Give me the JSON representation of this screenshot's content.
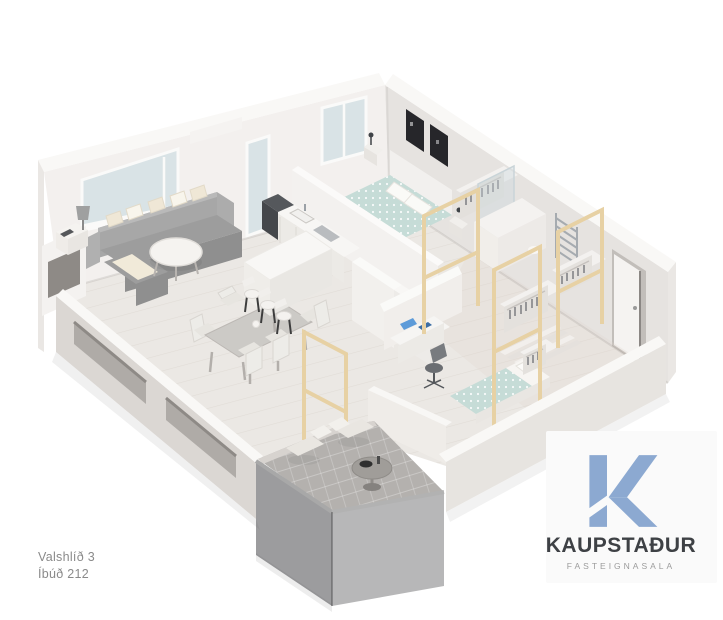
{
  "address": {
    "line1": "Valshlíð 3",
    "line2": "Íbúð 212"
  },
  "logo": {
    "monogram": "K",
    "name": "KAUPSTAÐUR",
    "tagline": "FASTEIGNASALA"
  },
  "brand": {
    "blue": "#8ca9d1",
    "dark": "#3e4145",
    "tagline_gray": "#9c9c9c",
    "address_gray": "#8a8a8a"
  },
  "palette": {
    "background": "#ffffff",
    "wall_light": "#f3f0ee",
    "wall_shadow": "#e6e3e0",
    "floor_wood": "#ebe8e4",
    "window_glass": "#d9e3e6",
    "balcony_glass": "#55555a",
    "balcony_tile": "#b4b1ae",
    "pine_wood": "#e7d1a4",
    "sofa_gray": "#9d9d9d",
    "duvet_teal": "#c6dcd7",
    "art_frame_dark": "#26262a",
    "appliance_dark": "#44474b",
    "office_accent_blue": "#5d9bd9"
  }
}
